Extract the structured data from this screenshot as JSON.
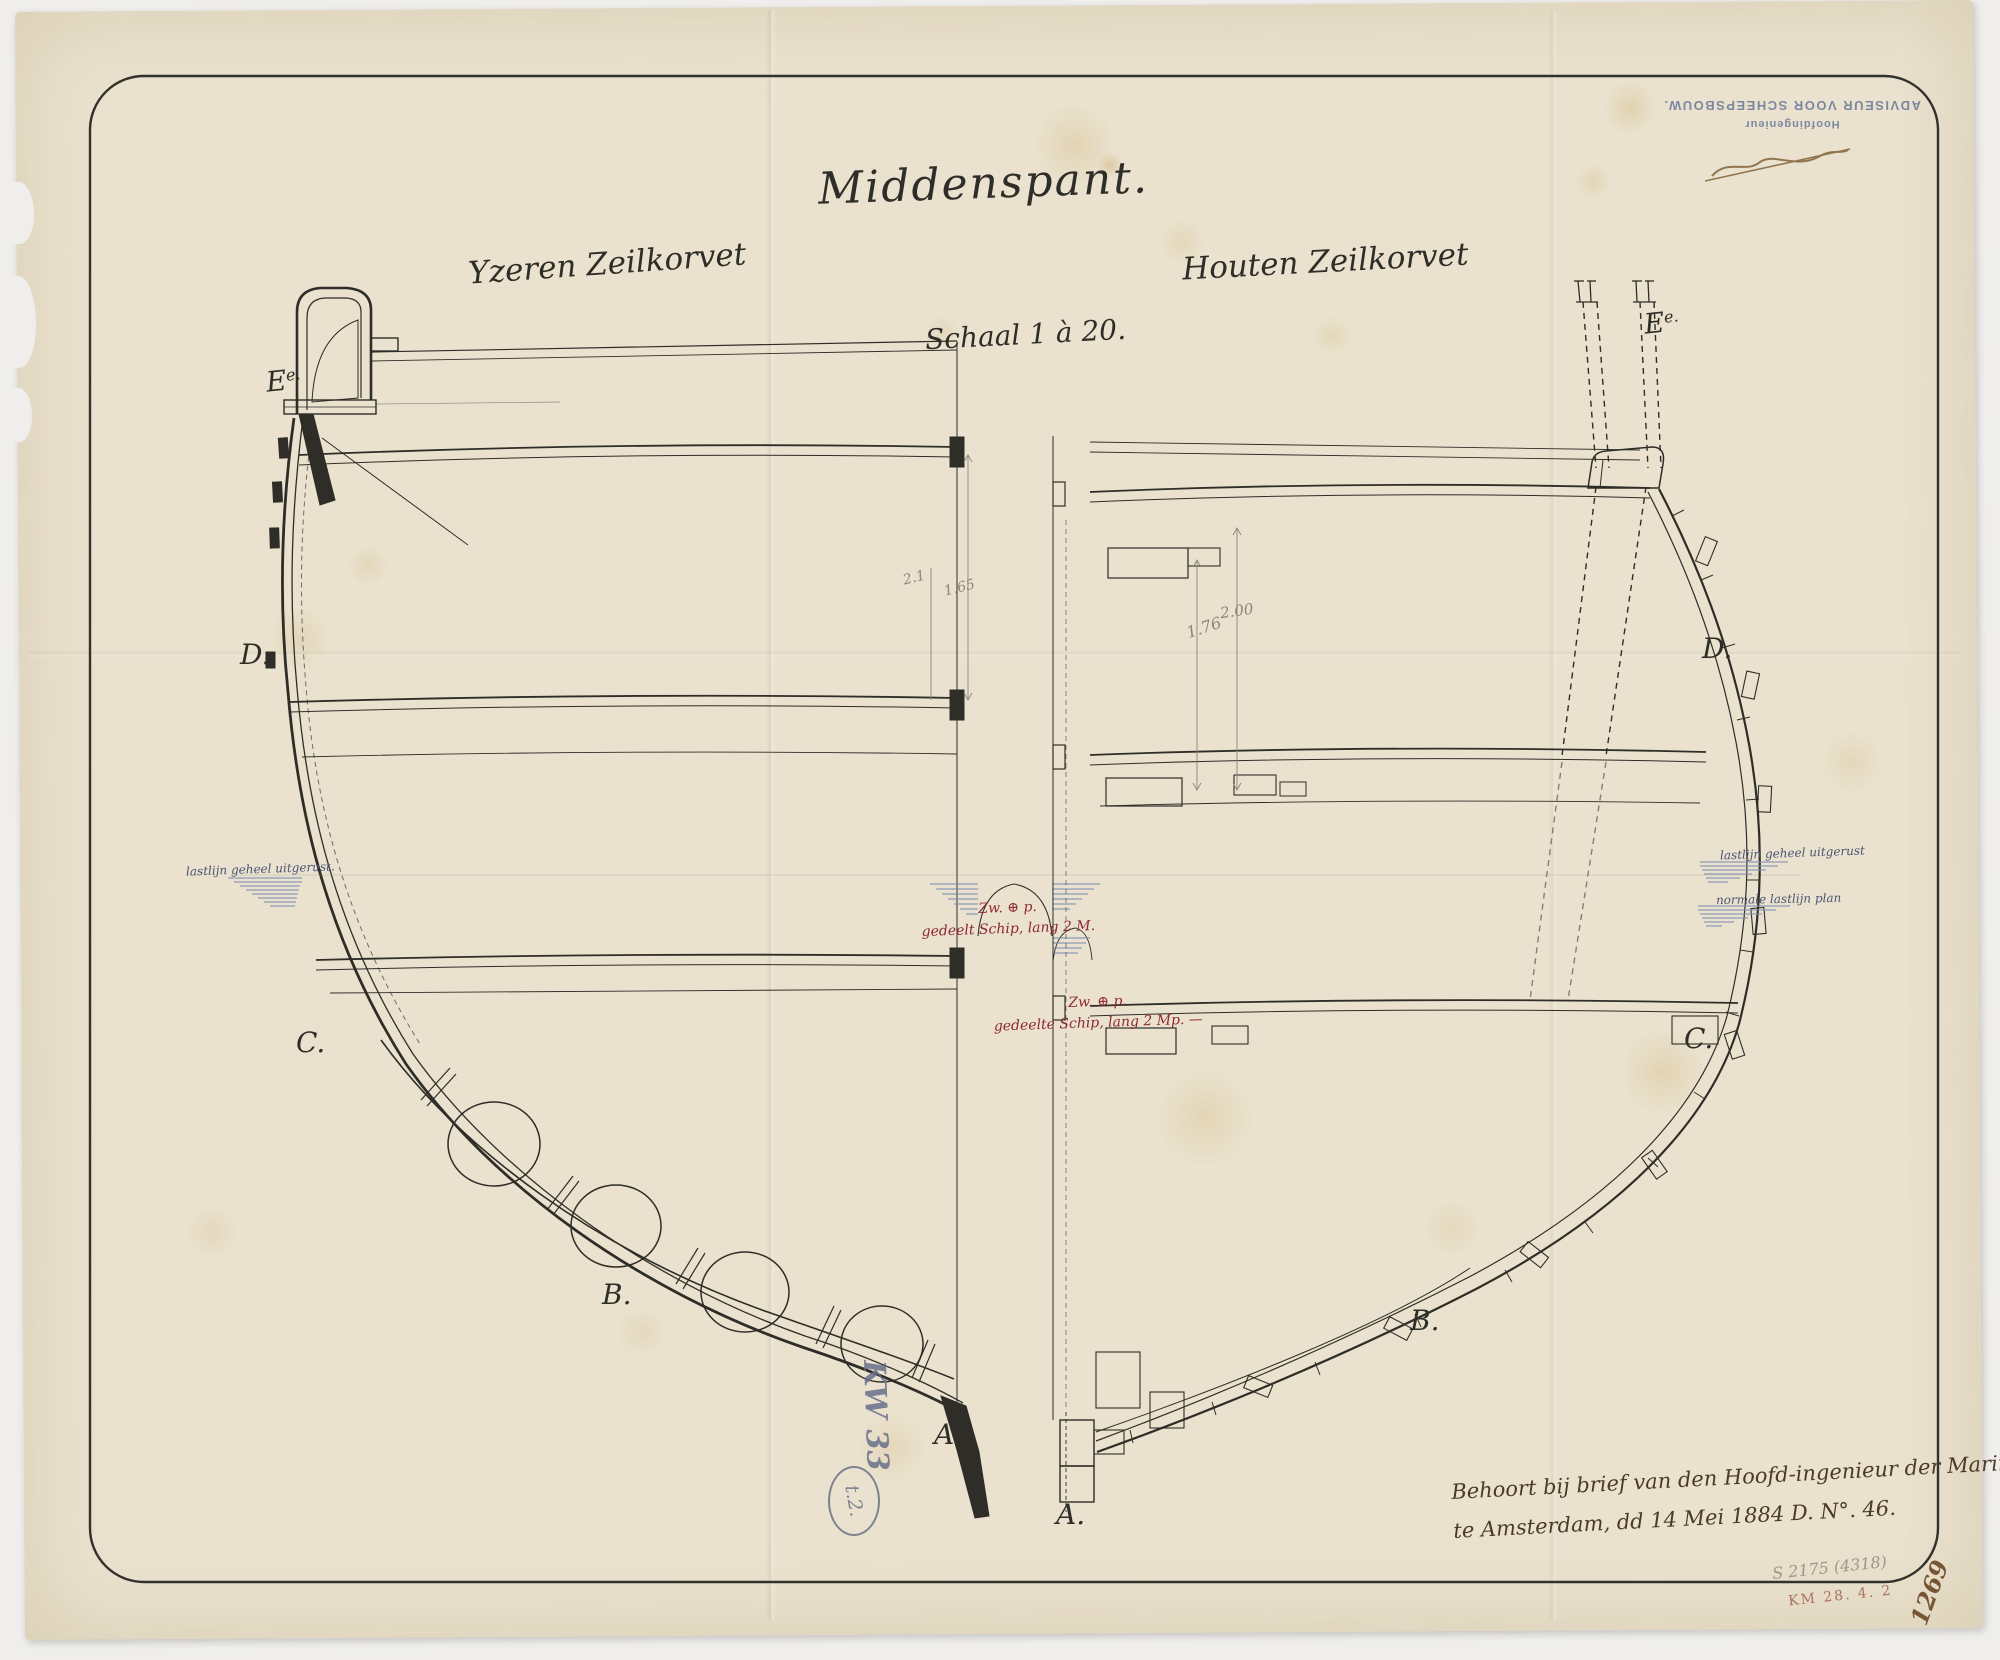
{
  "document": {
    "title": "Middenspant.",
    "left_half_label": "Yzeren Zeilkorvet",
    "right_half_label": "Houten Zeilkorvet",
    "scale_label": "Schaal 1 à 20."
  },
  "section_letters": {
    "left": {
      "e": "E",
      "e_sup": "e.",
      "d": "D.",
      "c": "C.",
      "b": "B.",
      "a": "A."
    },
    "right": {
      "e": "E",
      "e_sup": "e.",
      "d": "D.",
      "c": "C.",
      "b": "B.",
      "a": "A."
    }
  },
  "annotations": {
    "waterline_left": "lastlijn geheel uitgerust.",
    "waterline_right_upper": "lastlijn geheel uitgerust",
    "waterline_right_lower": "normale lastlijn plan",
    "red_upper_line1": "Zw. ⊕ p.",
    "red_upper_line2": "gedeelt Schip, lang 2 M.",
    "red_lower_line1": "Zw. ⊕ p.",
    "red_lower_line2": "gedeelte Schip, lang 2 Mp. —",
    "dim_left_a": "2.1",
    "dim_left_b": "1.65",
    "dim_right_a": "1.76",
    "dim_right_b": "2.00"
  },
  "stamp": {
    "line1": "Hoofdingenieur",
    "line2": "ADVISEUR VOOR SCHEEPSBOUW."
  },
  "footer": {
    "line1": "Behoort bij brief van den Hoofd-ingenieur der Marine",
    "line2": "te Amsterdam, dd 14 Mei 1884 D. N°. 46."
  },
  "archive_marks": {
    "kw_number": "KW 33",
    "circled_code": "t.2.",
    "pencil_top": "S 2175 (4318)",
    "pencil_code": "KM 28. 4. 2",
    "corner_number": "1269"
  },
  "colors": {
    "ink": "#2f2d27",
    "water_blue": "#7b90b5",
    "red_ink": "#8d2733",
    "stamp_blue": "#5d6f94",
    "paper": "#eae2cf"
  }
}
